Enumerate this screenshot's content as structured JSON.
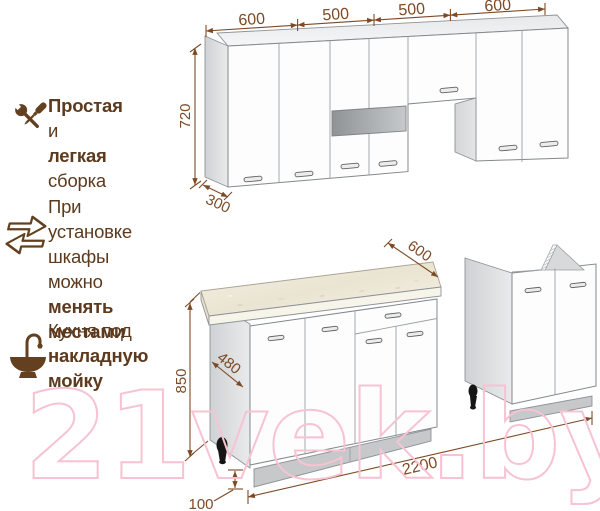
{
  "watermark": "21vek.by",
  "features": [
    {
      "icon": "tools-icon",
      "lines": [
        {
          "bold": "Простая",
          "rest": " и"
        },
        {
          "bold": "легкая",
          "rest": " сборка"
        }
      ]
    },
    {
      "icon": "swap-arrows-icon",
      "lines": [
        {
          "bold": "",
          "rest": "При установке"
        },
        {
          "bold": "",
          "rest": "шкафы можно"
        },
        {
          "bold": "менять местами",
          "rest": ""
        }
      ]
    },
    {
      "icon": "sink-icon",
      "lines": [
        {
          "bold": "",
          "rest": "Кухня под"
        },
        {
          "bold": "накладную",
          "rest": ""
        },
        {
          "bold": "мойку",
          "rest": ""
        }
      ]
    }
  ],
  "dimensions": {
    "upper_widths": [
      "600",
      "500",
      "500",
      "600"
    ],
    "upper_height": "720",
    "upper_depth": "300",
    "countertop_depth": "600",
    "cabinet_depth": "480",
    "lower_height": "850",
    "total_length": "2200",
    "plinth_height": "100"
  },
  "colors": {
    "dimension_lines": "#7d4a26",
    "feature_text": "#5d3a1d",
    "icon_brown": "#63401f",
    "watermark_pink": "#f7c3d2",
    "countertop_beige": "#efe9d8",
    "cabinet_gray": "#d9dbdc",
    "glass_gray": "#9b9fa2"
  }
}
